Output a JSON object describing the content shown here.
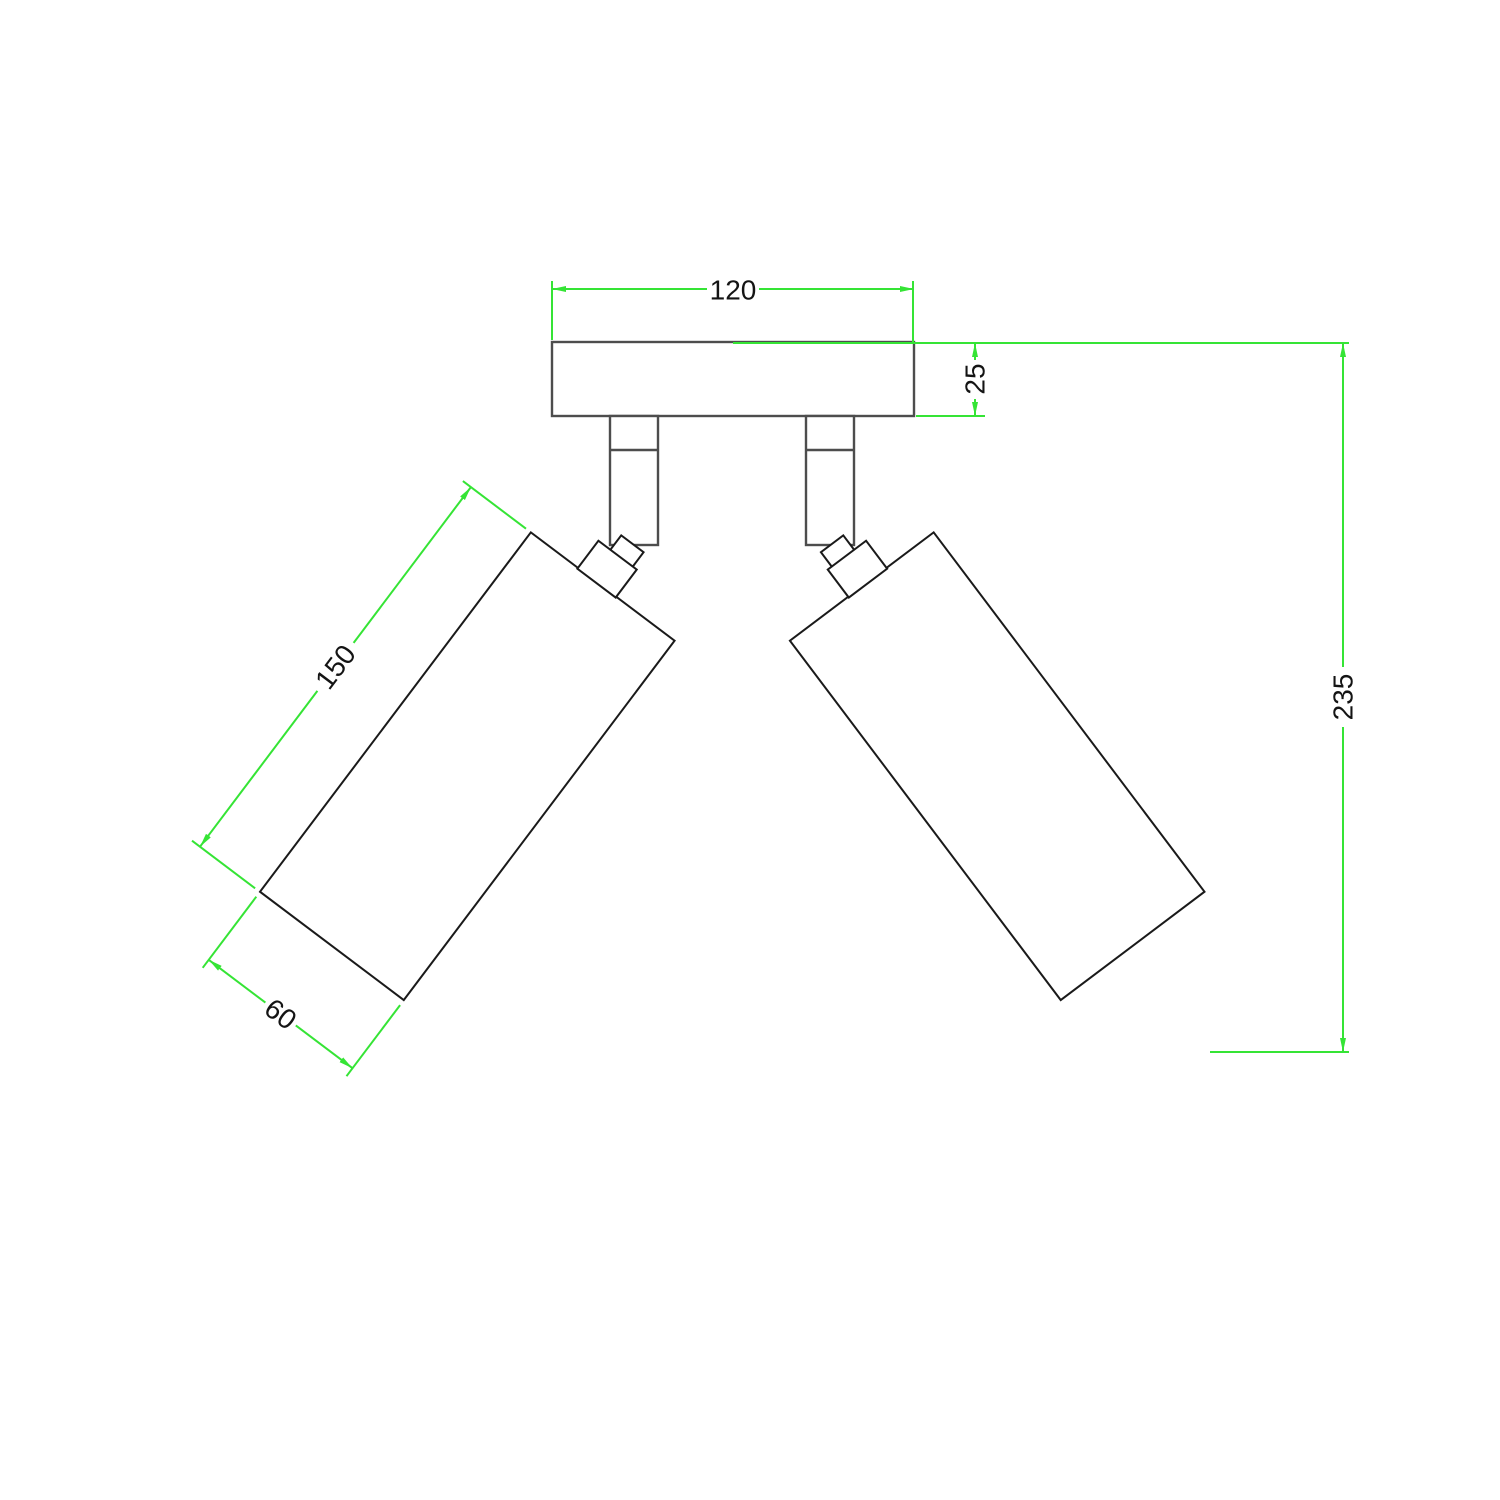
{
  "drawing": {
    "kind": "ceiling-spotlight-two-lamp-dimension-drawing",
    "dimensions": {
      "plate_width": "120",
      "plate_thickness": "25",
      "overall_height": "235",
      "lamp_length": "150",
      "lamp_diameter": "60"
    },
    "colors": {
      "dimension": "#35e435",
      "object_outline": "#1a1a1a",
      "mount_outline": "#4d4d4d",
      "label_text": "#141414",
      "background": "#ffffff"
    }
  }
}
